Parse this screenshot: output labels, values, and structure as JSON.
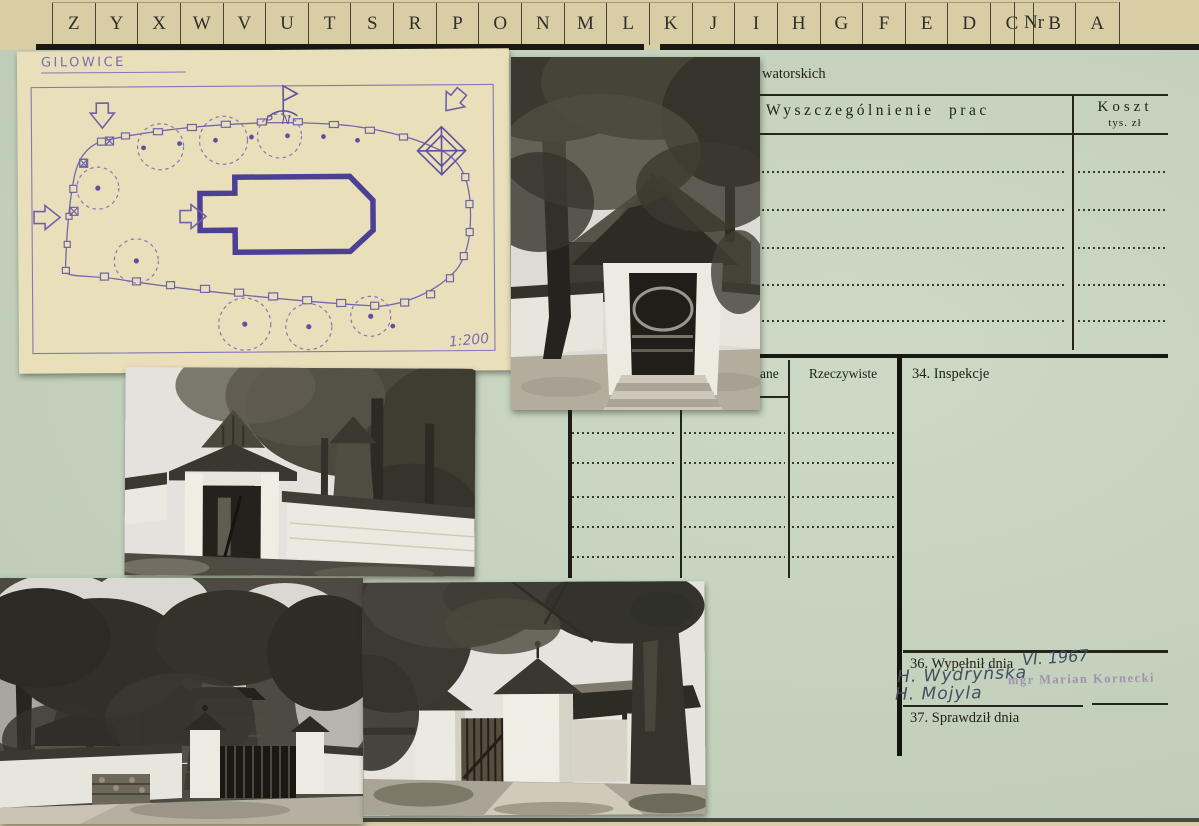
{
  "index_strip": {
    "letters": [
      "Z",
      "Y",
      "X",
      "W",
      "V",
      "U",
      "T",
      "S",
      "R",
      "P",
      "O",
      "N",
      "M",
      "L",
      "K",
      "J",
      "I",
      "H",
      "G",
      "F",
      "E",
      "D",
      "C",
      "B",
      "A"
    ],
    "nr_label": "Nr"
  },
  "form": {
    "heading_fragment": "watorskich",
    "works_table": {
      "col_works_header": "Wyszczególnienie prac",
      "col_cost_header": "Koszt",
      "col_cost_unit": "tys. zł",
      "empty_dotted_rows": 5
    },
    "progress_table": {
      "col_planned_fragment": "ane",
      "col_actual_header": "Rzeczywiste",
      "empty_dotted_rows": 5
    },
    "section_34_label": "34. Inspekcje",
    "section_36_label": "36. Wypełnił dnia",
    "section_36_date_handwritten": "VI. 1967",
    "signature_line_1": "H. Wydryńska",
    "signature_line_2": "H. Mojyla",
    "stamp_text": "mgr Marian Kornecki",
    "section_37_label": "37. Sprawdził dnia"
  },
  "site_plan": {
    "place_name": "GILOWICE",
    "north_label": "PN",
    "scale": "1:200",
    "description": "Hand-drawn purple ink site plan: oval churchyard wall with posts, trees, gate arrows, belfry and church outline"
  },
  "photos": {
    "photo_top_desc": "Lychgate with shingled roof and stone steps, wooden church behind trees",
    "photo_middle_desc": "Gabled gate in white plank fence with shingled coping",
    "photo_bottom_left_desc": "Wooden church with tall tower behind fence with gate pillars",
    "photo_bottom_middle_desc": "White masonry gate pillars with pyramidal caps and wooden picket gate"
  },
  "colors": {
    "card_green": "#c6d5bf",
    "strip_cream": "#d9cda6",
    "plan_paper": "#e9dfba",
    "plan_ink": "#7468ab",
    "stamp_violet": "#8a6ca8",
    "handwriting_ink": "#434e63"
  }
}
